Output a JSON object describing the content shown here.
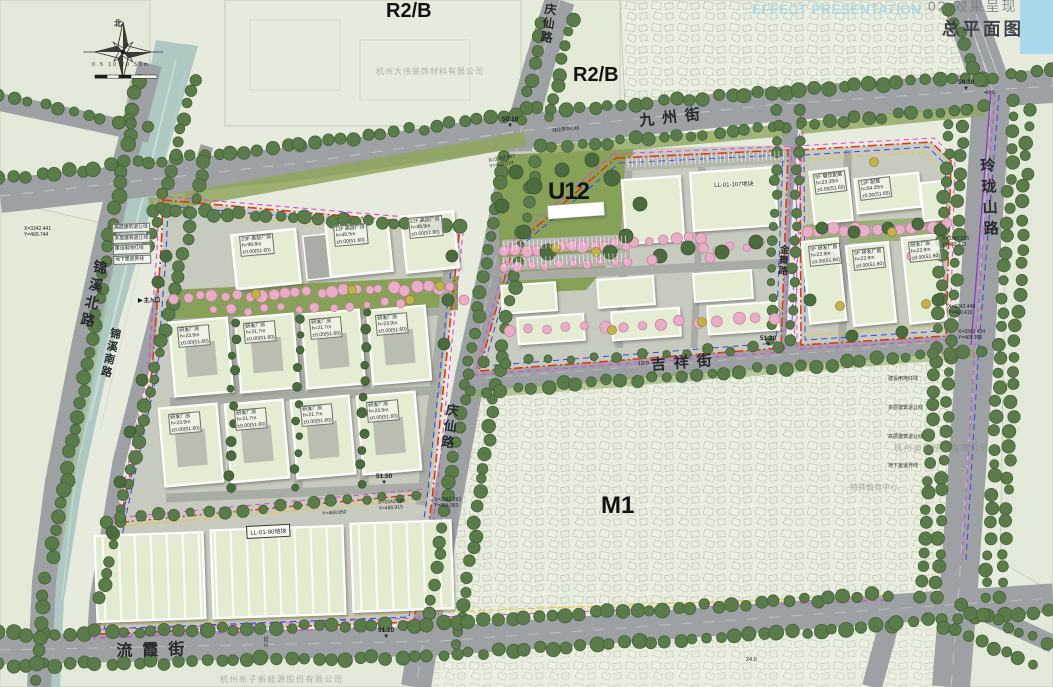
{
  "title_bar": {
    "watermark_en": "EFFECT PRESENTATION",
    "section_label": "02 效果呈现",
    "page_title": "总平面图"
  },
  "zones": {
    "r2b_top": "R2/B",
    "r2b_right": "R2/B",
    "u12": "U12",
    "m1": "M1"
  },
  "streets": {
    "jiuzhou": "九州街",
    "qingxian_top": "庆仙路",
    "qingxian_mid": "庆仙路",
    "jinxi_north": "锦溪北路",
    "jinxi_south": "锦溪南路",
    "jixiang": "吉祥街",
    "liuxia": "流霞街",
    "linglongshan": "玲珑山路",
    "jinwu": "金舞路"
  },
  "plots": {
    "left": "LL-01-90地块",
    "mid": "LL-01-107地块"
  },
  "legend_left": [
    "高层建筑退让线",
    "多层建筑退让线",
    "建设用地红线",
    "地下室退界线"
  ],
  "legend_right": [
    "建设用地红线",
    "多层建筑退让线",
    "高层建筑退让线",
    "地下室退界线"
  ],
  "compass": {
    "north": "北",
    "scale": "0 5 10 20 50m"
  },
  "building_labels": {
    "tower_1": "23F 高层厂房\nh=98.8m\n±0.00(51.60)",
    "tower_2": "11F 高层厂房\nh=49.5m\n±0.00(51.60)",
    "tower_3": "11F 高层厂房\nh=49.9m\n±0.00(51.60)",
    "rd_1": "研发厂房\nh=23.9m\n±0.00(51.60)",
    "rd_2": "研发厂房\nh=21.7m\n±0.00(51.60)",
    "rd_3": "研发厂房\nh=21.7m\n±0.00(51.60)",
    "rd_4": "研发厂房\nh=23.9m\n±0.00(51.60)",
    "rd_5": "研发厂房\nh=23.9m\n±0.00(51.60)",
    "rd_6": "研发厂房\nh=21.7m\n±0.00(51.60)",
    "rd_7": "研发厂房\nh=21.7m\n±0.00(51.60)",
    "rd_8": "研发厂房\nh=23.9m\n±0.00(51.60)",
    "canyin": "5F 餐饮配套\nh=23.35m\n±0.00(51.65)",
    "peitao": "12F 配套\nh=54.35m\n±0.00(51.65)",
    "rd_r1": "5F 研发厂房\nh=23.9m\n±0.00(51.60)",
    "rd_r2": "5F 研发厂房\nh=23.9m\n±0.00(51.60)",
    "rd_r3": "研发厂房\nh=23.9m\n±0.00(51.60)"
  },
  "annotations": {
    "coords": [
      "X=3342.567\nY=469.014",
      "X=3342.283\nY=468.953",
      "X=3342.441\nY=468.744",
      "X=3342.700\nY=468.915",
      "Y=468.850",
      "X=3342.505\nY=469.412",
      "X=3342.448\nY=469.419",
      "X=3342.434\nY=469.355"
    ],
    "elevations": [
      "50.10",
      "50.30",
      "51.20",
      "51.50",
      "51.10"
    ],
    "misc": {
      "green_belt": "绿化带中心线",
      "main_entrance": "主入口",
      "w18": "18.0",
      "w24": "24.0",
      "w32": "32.0",
      "w40": "40.0"
    }
  },
  "watermarks": [
    "杭州大伟装饰材料有限公司",
    "杭州美临塑业有限公司",
    "杭州新子新能源股份有限公司",
    "特殊教育中心"
  ],
  "icons": {
    "elevation_marker": "▼",
    "entrance_arrow": "▶"
  },
  "colors": {
    "context_bg": "#e7ebdd",
    "context_block": "#e2e8d6",
    "village_fill": "#eaeede",
    "road": "#9da1a4",
    "river": "#afc9c2",
    "river_streak": "#d2e2da",
    "lawn": "#87a158",
    "ground": "#c7cbbf",
    "inner_road": "#a8aca4",
    "roof": "#e4edd4",
    "court": "#b9beb0",
    "tree_green": "#5c7b4a",
    "tree_dark": "#4c6b3e",
    "tree_pink": "#e9aec7",
    "tree_yellow": "#c2b24b",
    "boundary_red": "#e63214",
    "boundary_magenta": "#e63ce0",
    "boundary_blue": "#3a46e8",
    "boundary_yellow": "#e8c832",
    "boundary_purple": "#8a36cc",
    "accent_blue": "#a9d8ec"
  }
}
